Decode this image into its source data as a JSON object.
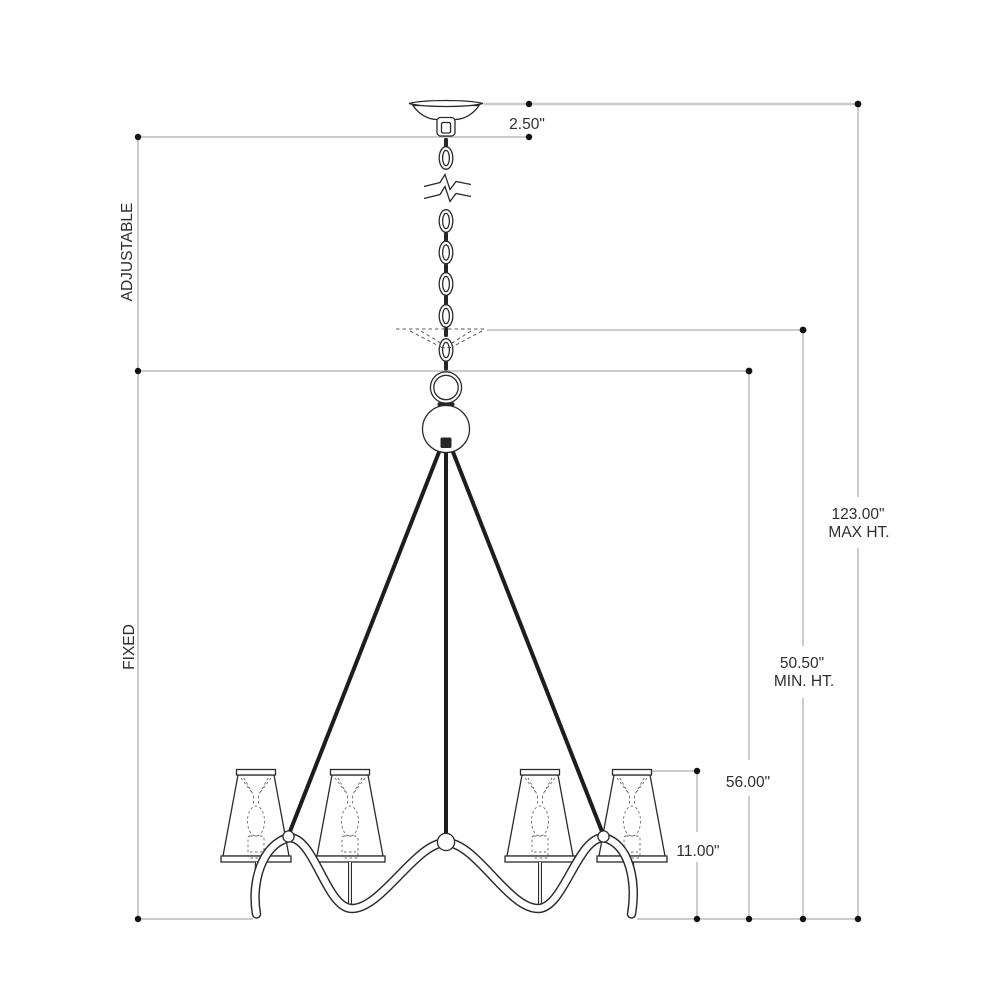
{
  "drawing": {
    "type": "chandelier-installation-dimension-drawing",
    "dimensions": {
      "canopy": {
        "value": "2.50\""
      },
      "overall_max": {
        "value": "123.00\"",
        "label": "MAX HT."
      },
      "overall_min": {
        "value": "50.50\"",
        "label": "MIN. HT."
      },
      "fixture": {
        "value": "56.00\""
      },
      "body": {
        "value": "11.00\""
      },
      "chain_section": {
        "label": "ADJUSTABLE"
      },
      "fixture_section": {
        "label": "FIXED"
      }
    },
    "colors": {
      "background": "#ffffff",
      "drawing_stroke": "#2b2b2b",
      "dimension_stroke": "#9a9a9a",
      "text": "#2e2e2e"
    },
    "parts": [
      "ceiling-canopy",
      "hanging-chain",
      "chain-break-symbol",
      "raised-canopy-dashed",
      "hang-ring",
      "ball-finial",
      "support-rods",
      "serpentine-arm",
      "candle-shades"
    ],
    "shade_count": 4
  }
}
